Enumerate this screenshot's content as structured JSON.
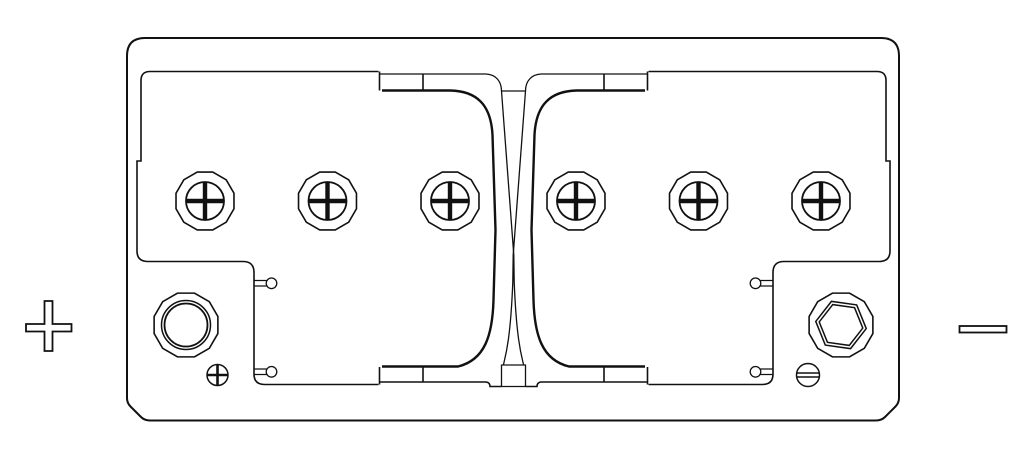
{
  "diagram": {
    "subject": "Battery top view line drawing",
    "polarity_markers": {
      "positive": "+",
      "negative": "−"
    },
    "colors": {
      "line": "#111111",
      "background": "#ffffff"
    },
    "elements": {
      "vent_caps": 6,
      "terminals": 2,
      "screws": 2,
      "vent_pins": 4
    }
  }
}
